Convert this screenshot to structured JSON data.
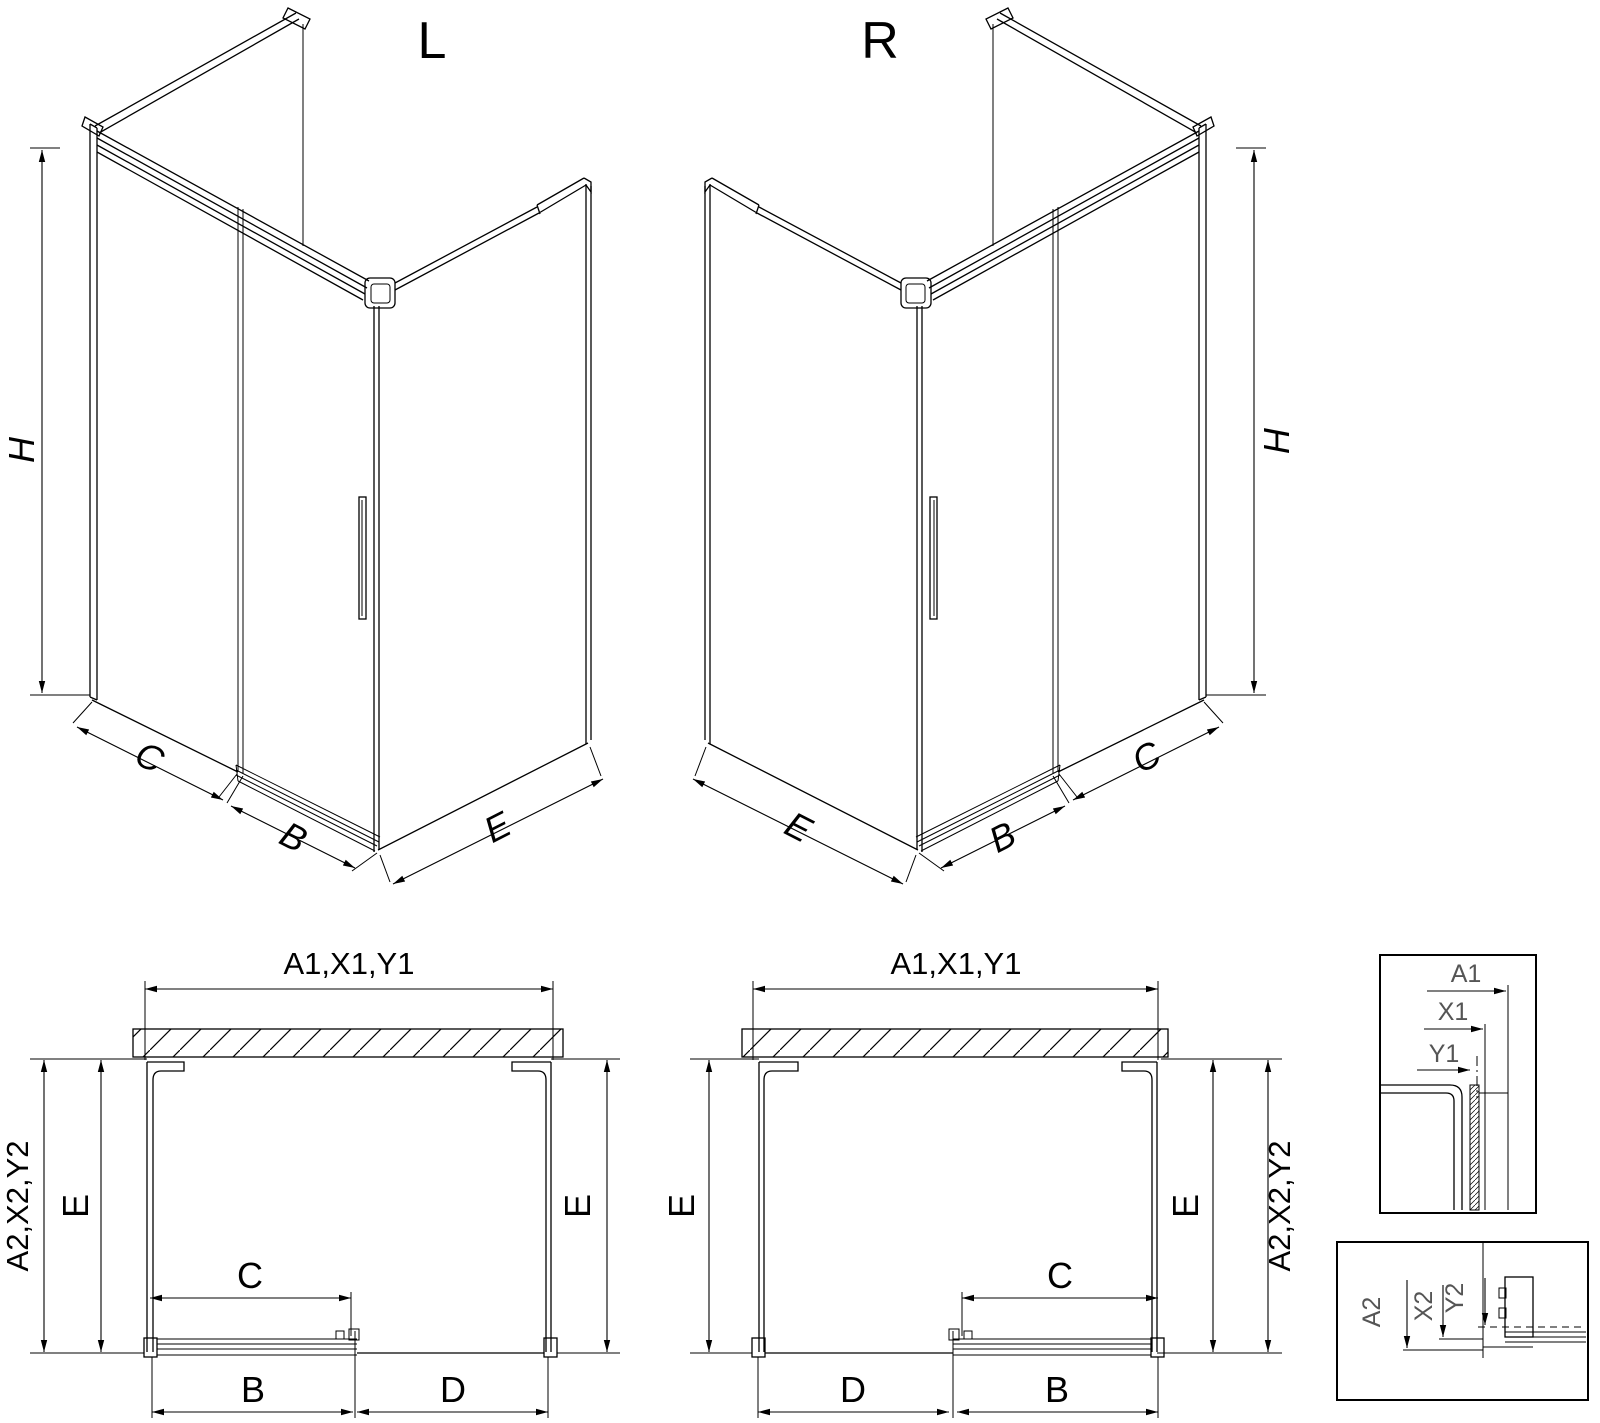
{
  "drawing": {
    "background": "#ffffff",
    "line_color": "#000000",
    "detail_label_color": "#555555",
    "iso_views": [
      {
        "label": "L",
        "dims": {
          "height": "H",
          "fixed_panel": "C",
          "door": "B",
          "side_panel": "E"
        }
      },
      {
        "label": "R",
        "dims": {
          "height": "H",
          "fixed_panel": "C",
          "door": "B",
          "side_panel": "E"
        }
      }
    ],
    "plan_views": [
      {
        "variant": "L",
        "width_dim": "A1,X1,Y1",
        "depth_dim": "A2,X2,Y2",
        "side_dim_left": "E",
        "side_dim_right": "E",
        "opening_dim": "C",
        "bottom_dim_left": "B",
        "bottom_dim_right": "D"
      },
      {
        "variant": "R",
        "width_dim": "A1,X1,Y1",
        "depth_dim": "A2,X2,Y2",
        "side_dim_left": "E",
        "side_dim_right": "E",
        "opening_dim": "C",
        "bottom_dim_left": "D",
        "bottom_dim_right": "B"
      }
    ],
    "detail_views": [
      {
        "name": "wall-profile-detail",
        "dims": [
          "A1",
          "X1",
          "Y1"
        ]
      },
      {
        "name": "bottom-rail-detail",
        "dims": [
          "A2",
          "X2",
          "Y2"
        ]
      }
    ]
  }
}
